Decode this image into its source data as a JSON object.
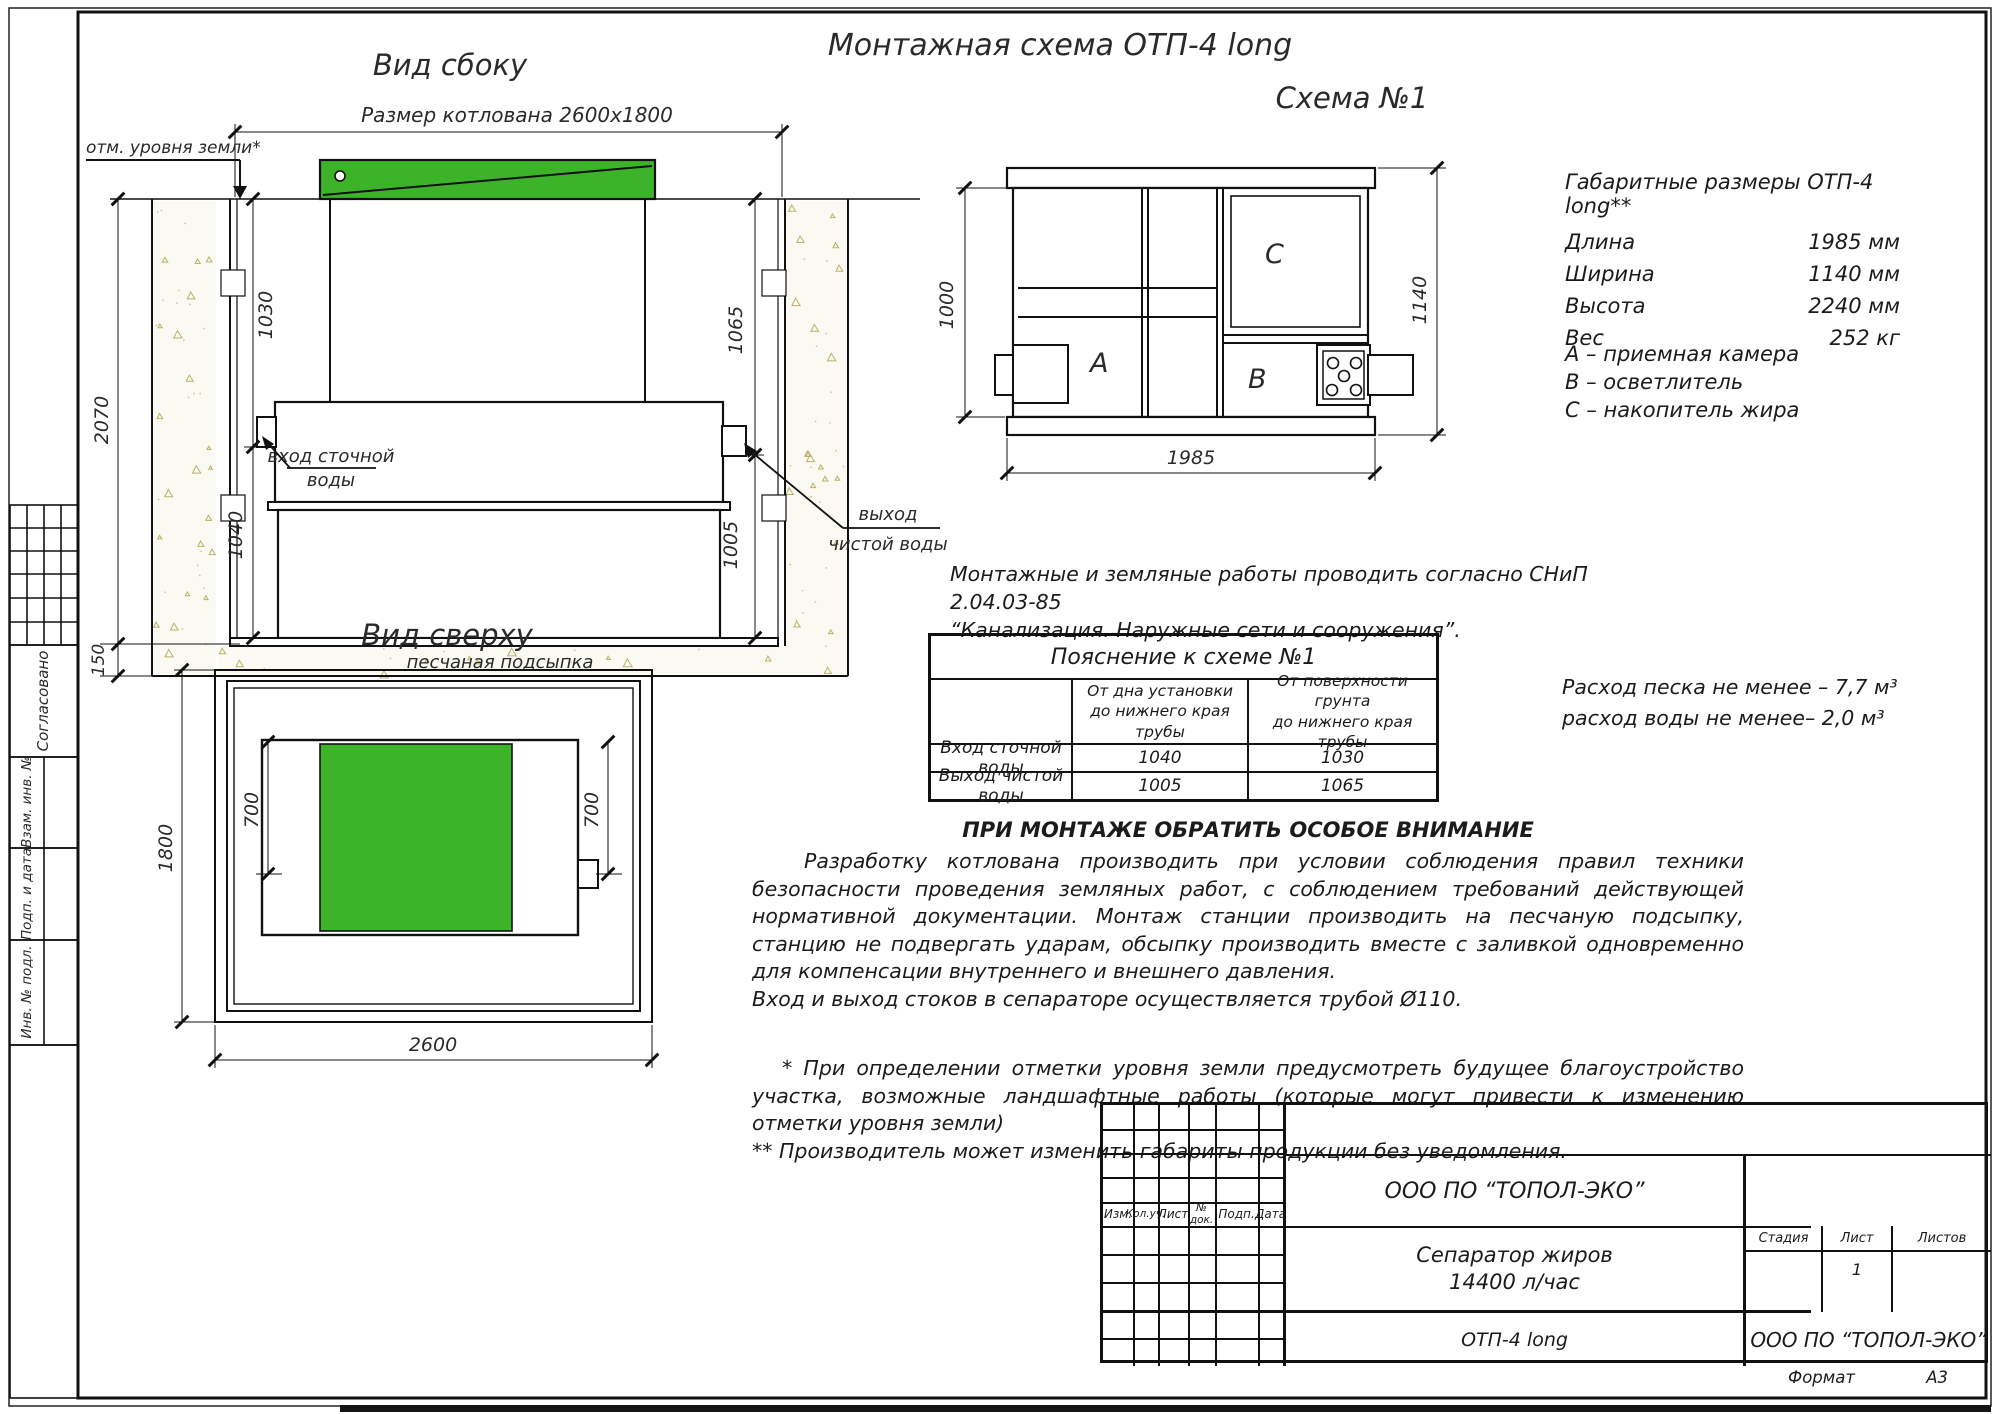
{
  "colors": {
    "green": "#3db32a",
    "sand_stroke": "#b9b168",
    "line": "#1b1b1b"
  },
  "sheet": {
    "title": "Монтажная схема ОТП-4 long",
    "format_label": "Формат",
    "format_value": "А3"
  },
  "side_view": {
    "title": "Вид сбоку",
    "pit_size_label": "Размер котлована 2600х1800",
    "ground_label": "отм. уровня земли*",
    "dim_depth": "2070",
    "dim_sand": "150",
    "dim_inlet_ground": "1030",
    "dim_inlet_bottom": "1040",
    "dim_outlet_ground": "1065",
    "dim_outlet_bottom": "1005",
    "inlet_label_1": "вход сточной",
    "inlet_label_2": "воды",
    "outlet_label_1": "выход",
    "outlet_label_2": "чистой воды",
    "sand_label": "песчаная подсыпка"
  },
  "top_view": {
    "title": "Вид сверху",
    "dim_width": "1800",
    "dim_700_left": "700",
    "dim_700_right": "700",
    "dim_length": "2600"
  },
  "scheme": {
    "title": "Схема №1",
    "dim_left": "1000",
    "dim_right": "1140",
    "dim_bottom": "1985",
    "label_a": "А",
    "label_b": "В",
    "label_c": "С"
  },
  "specs": {
    "title": "Габаритные размеры ОТП-4 long**",
    "rows": [
      {
        "label": "Длина",
        "value": "1985 мм"
      },
      {
        "label": "Ширина",
        "value": "1140 мм"
      },
      {
        "label": "Высота",
        "value": "2240 мм"
      },
      {
        "label": "Вес",
        "value": "252 кг"
      }
    ],
    "legend": [
      "А – приемная  камера",
      "В – осветлитель",
      "С – накопитель жира"
    ]
  },
  "snip": {
    "line1": "Монтажные и земляные работы проводить согласно СНиП 2.04.03-85",
    "line2": "“Канализация. Наружные сети и сооружения”."
  },
  "explain_table": {
    "title": "Пояснение к схеме №1",
    "col_from_bottom": "От дна установки\nдо нижнего края трубы",
    "col_from_ground": "От поверхности грунта\nдо нижнего края трубы",
    "rows": [
      {
        "name": "Вход сточной воды",
        "from_bottom": "1040",
        "from_ground": "1030"
      },
      {
        "name": "Выход чистой воды",
        "from_bottom": "1005",
        "from_ground": "1065"
      }
    ]
  },
  "consumption": {
    "line1": "Расход песка не менее – 7,7 м³",
    "line2": "расход воды не менее– 2,0 м³"
  },
  "attention": {
    "heading": "ПРИ МОНТАЖЕ ОБРАТИТЬ ОСОБОЕ ВНИМАНИЕ",
    "paragraph": "Разработку котлована производить при условии соблюдения правил техники безопасности проведения земляных работ, с соблюдением требований действующей нормативной документации. Монтаж станции производить на песчаную подсыпку, станцию не подвергать ударам, обсыпку производить вместе с заливкой одновременно для компенсации внутреннего и внешнего давления.",
    "paragraph2": "Вход и выход стоков в сепараторе осуществляется трубой Ø110.",
    "footnote1": "* При определении отметки уровня земли предусмотреть будущее благоустройство участка, возможные ландшафтные работы (которые могут привести к изменению отметки уровня земли)",
    "footnote2": "** Производитель может изменить габариты продукции без уведомления."
  },
  "stamp": {
    "cols": [
      "Изм.",
      "Кол.уч.",
      "Лист",
      "№ док.",
      "Подп.",
      "Дата"
    ],
    "company_top": "ООО ПО “ТОПОЛ-ЭКО”",
    "product_name_1": "Сепаратор жиров",
    "product_name_2": "14400 л/час",
    "model": "ОТП-4 long",
    "company_bottom": "ООО ПО “ТОПОЛ-ЭКО”",
    "stage_label": "Стадия",
    "sheet_label": "Лист",
    "sheets_label": "Листов",
    "sheet_value": "1"
  },
  "sidebar": {
    "agreed": "Согласовано",
    "inv_replace": "Взам. инв. №",
    "sign_date": "Подп. и дата",
    "inv_orig": "Инв. № подл."
  }
}
